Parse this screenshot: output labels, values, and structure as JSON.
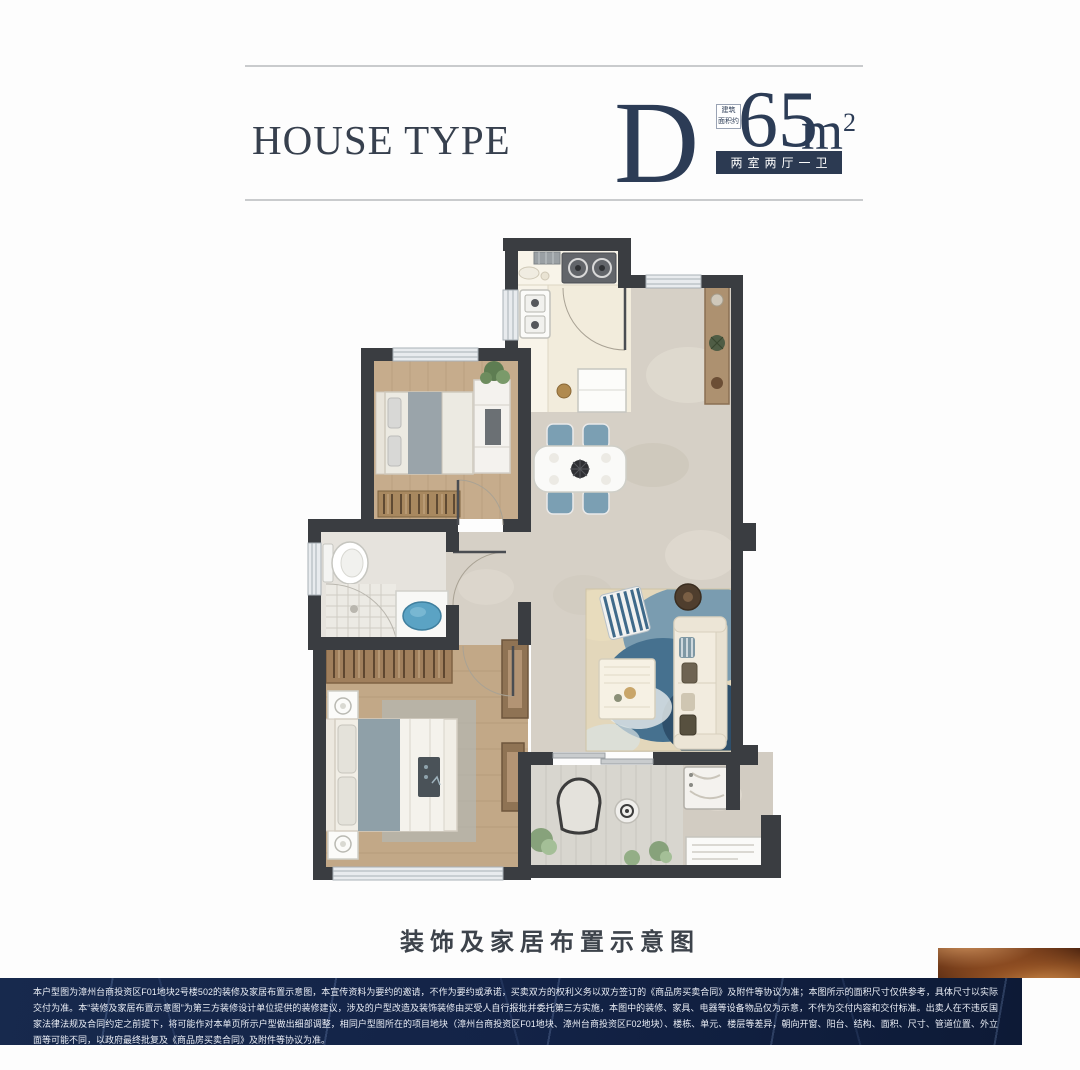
{
  "header": {
    "title": "HOUSE TYPE",
    "type_letter": "D",
    "area_note_top": "建筑",
    "area_note_bottom": "面积约",
    "area_value": "65",
    "area_unit": "m",
    "area_unit_sup": "2",
    "badge": "两室两厅一卫"
  },
  "floorplan": {
    "caption": "装饰及家居布置示意图"
  },
  "footer": {
    "disclaimer": "本户型图为漳州台商投资区F01地块2号楼502的装修及家居布置示意图，本宣传资料为要约的邀请，不作为要约或承诺，买卖双方的权利义务以双方签订的《商品房买卖合同》及附件等协议为准；本图所示的面积尺寸仅供参考，具体尺寸以实际交付为准。本“装修及家居布置示意图”为第三方装修设计单位提供的装修建议，涉及的户型改造及装饰装修由买受人自行报批并委托第三方实施，本图中的装修、家具、电器等设备物品仅为示意，不作为交付内容和交付标准。出卖人在不违反国家法律法规及合同约定之前提下，将可能作对本单页所示户型做出细部调整，相同户型图所在的项目地块（漳州台商投资区F01地块、漳州台商投资区F02地块）、楼栋、单元、楼层等差异，朝向开窗、阳台、结构、面积、尺寸、管道位置、外立面等可能不同，以政府最终批复及《商品房买卖合同》及附件等协议为准。"
  },
  "colors": {
    "accent_navy": "#2c3a52",
    "divider_gray": "#c9cbcd",
    "wall_dark": "#3a3d41",
    "marble_floor": "#d6d0c6",
    "wood_floor": "#c6ac8c",
    "kitchen_floor": "#f2ecdc",
    "rug_ocean": "#46718f",
    "footer_navy": "#132347",
    "copper": "#c98648"
  }
}
